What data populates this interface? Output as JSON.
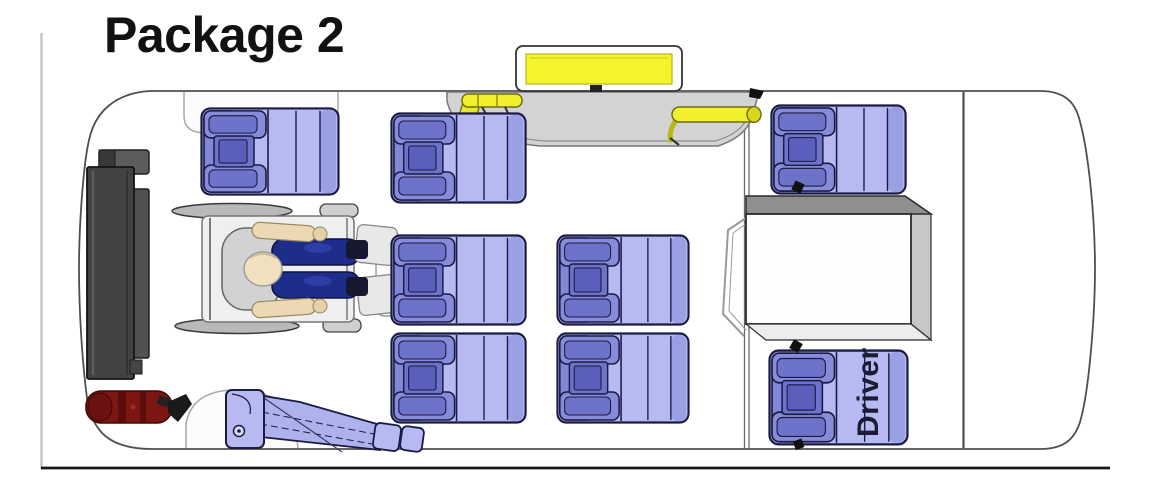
{
  "title": "Package 2",
  "floorplan": {
    "driver_seat_label": "Driver",
    "seat_count": {
      "fixed_passenger_seats": 7,
      "driver_seat": 1,
      "wheelchair_position": 1,
      "folded_flip_seat": 1
    },
    "visible_features": [
      "wheelchair-passenger",
      "rear-wheelchair-lift",
      "fire-extinguisher",
      "entry-door-ramp-with-grab-rails",
      "entry-step-yellow-platform",
      "folded-flip-seat-over-wheel-well",
      "engine-cover",
      "driver-seat"
    ],
    "colors": {
      "seat": "#b6baf0",
      "seat_back": "#868cda",
      "seat_back_dark": "#5a5fbb",
      "seat_outline": "#1a1a44",
      "occupant_clothing": "#1e2d8a",
      "occupant_skin": "#eedcb8",
      "wheelchair_frame": "#d8d8d8",
      "lift": "#424242",
      "fire_extinguisher": "#7c1613",
      "door_ramp": "#d3d3d3",
      "grab_rail_yellow": "#f1ef2e",
      "body_outline": "#4f4f4f",
      "frame_border": "#1c1c1c",
      "title_color": "#111111"
    }
  }
}
